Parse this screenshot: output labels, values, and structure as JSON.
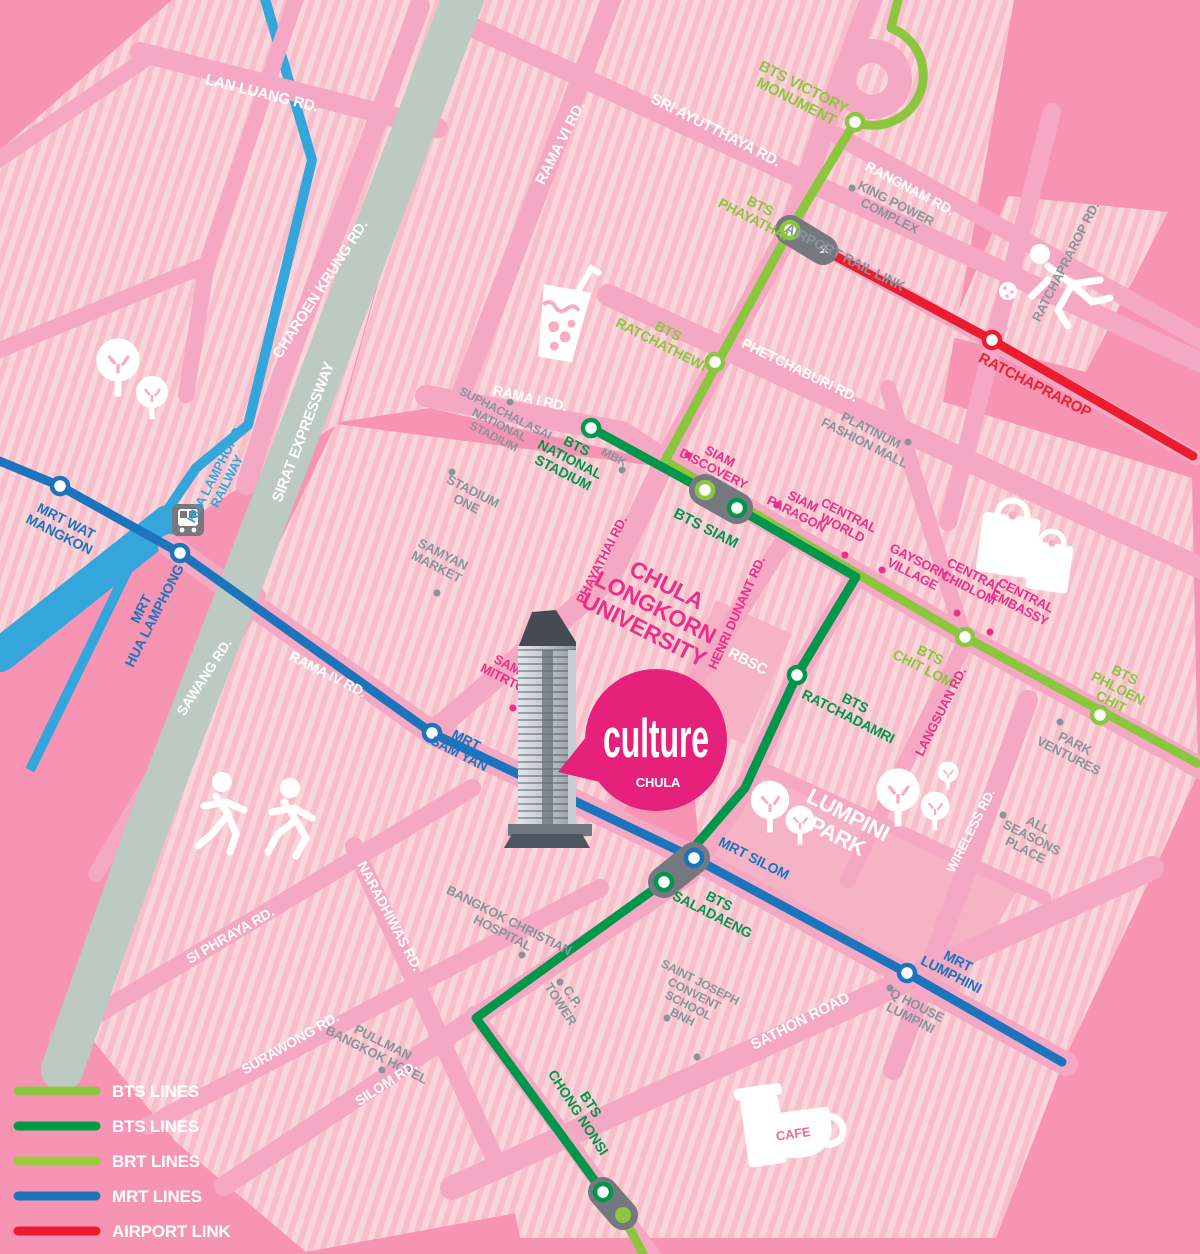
{
  "title": "Culture Chula location map (Bangkok transit map)",
  "palette": {
    "background": "#F794B3",
    "block_base": "#F8BFCB",
    "block_stripe": "#FAD4DB",
    "road": "#F4A8C3",
    "park": "#F7B3C6",
    "expressway": "#BDC9C3",
    "railway_blue": "#35A6DC",
    "bts_light": "#8CC63F",
    "bts_dark": "#00964B",
    "brt": "#9BCB3C",
    "mrt_blue": "#1B74BC",
    "airport_red": "#EB1C2D",
    "gray_text": "#8A939B",
    "pink_text": "#EC2E86",
    "logo_magenta": "#E5217B",
    "capsule_gray": "#75797F"
  },
  "logo": {
    "title": "culture",
    "subtitle": "CHULA"
  },
  "icons": {
    "airplane_glyph": "✈",
    "names": [
      "tree-icon",
      "train-icon",
      "bubble-tea-icon",
      "runner-icon",
      "exercise-icon",
      "shopping-bags-icon",
      "cafe-icon",
      "airplane-icon"
    ]
  },
  "legend": {
    "items": [
      {
        "label": "BTS LINES",
        "color": "#8CC63F"
      },
      {
        "label": "BTS LINES",
        "color": "#009A44"
      },
      {
        "label": "BRT LINES",
        "color": "#9BCB3C"
      },
      {
        "label": "MRT LINES",
        "color": "#1B74BC"
      },
      {
        "label": "AIRPORT LINK",
        "color": "#EB1C2D"
      }
    ]
  },
  "labels": {
    "lan_luang": "LAN LUANG RD.",
    "charoen_krung": "CHAROEN KRUNG RD.",
    "sirat": "SIRAT EXPRESSWAY",
    "rama_vi": "RAMA VI RD.",
    "sri_ayutthaya": "SRI AYUTTHAYA RD.",
    "rangnam": "RANGNAM RD.",
    "king_power": [
      "KING POWER",
      "COMPLEX"
    ],
    "ratchaprarop_rd": "RATCHAPRAROP RD.",
    "victory": [
      "BTS VICTORY",
      "MONUMENT"
    ],
    "phayathai_sta": [
      "BTS",
      "PHAYATHAI"
    ],
    "airport_rail_link": "AIRPORT RAIL LINK",
    "ratchathewi": [
      "BTS",
      "RATCHATHEWI"
    ],
    "phetchaburi": "PHETCHABURI RD.",
    "ratchaprarop_line": "RATCHAPRAROP",
    "platinum": [
      "PLATINUM",
      "FASHION MALL"
    ],
    "rama_i": "RAMA I RD.",
    "suphachalasai": [
      "SUPHACHALASAI",
      "NATIONAL",
      "STADIUM"
    ],
    "national_stadium": [
      "BTS",
      "NATIONAL",
      "STADIUM"
    ],
    "mbk": "MBK",
    "stadium_one": [
      "STADIUM",
      "ONE"
    ],
    "samyan_market": [
      "SAMYAN",
      "MARKET"
    ],
    "siam_discovery": [
      "SIAM",
      "DISCOVERY"
    ],
    "bts_siam": "BTS SIAM",
    "siam_paragon": [
      "SIAM",
      "PARAGON"
    ],
    "central_world": [
      "CENTRAL",
      "WORLD"
    ],
    "gaysorn": [
      "GAYSORN",
      "VILLAGE"
    ],
    "central_chidlom": [
      "CENTRAL",
      "CHIDLOM"
    ],
    "central_embassy": [
      "CENTRAL",
      "EMBASSY"
    ],
    "chit_lom": [
      "BTS",
      "CHIT LOM"
    ],
    "phloen_chit": [
      "BTS",
      "PHLOEN",
      "CHIT"
    ],
    "park_ventures": [
      "PARK",
      "VENTURES"
    ],
    "all_seasons": [
      "ALL",
      "SEASONS",
      "PLACE"
    ],
    "chula_univ": [
      "CHULA",
      "LONGKORN",
      "UNIVERSITY"
    ],
    "henri_dunant": "HENRI DUNANT RD.",
    "rbsc": "RBSC",
    "ratchadamri": [
      "BTS",
      "RATCHADAMRI"
    ],
    "langsuan": "LANGSUAN RD.",
    "wireless": "WIRELESS RD.",
    "phayathai_rd": "PHAYATHAI RD.",
    "samyan_mitrtown": [
      "SAMYAN",
      "MITRTOWN"
    ],
    "mrt_sam_yan": [
      "MRT",
      "SAM YAN"
    ],
    "sawang": "SAWANG RD.",
    "rama_iv": "RAMA IV RD.",
    "mrt_wat_mangkon": [
      "MRT WAT",
      "MANGKON"
    ],
    "mrt_hua_lamphong": [
      "MRT",
      "HUA LAMPHONG"
    ],
    "hua_lamphong_railway": [
      "HUA LAMPHONG",
      "RAILWAY"
    ],
    "lumpini": [
      "LUMPINI",
      "PARK"
    ],
    "mrt_silom": "MRT SILOM",
    "saladaeng": [
      "BTS",
      "SALADAENG"
    ],
    "mrt_lumphini": [
      "MRT",
      "LUMPHINI"
    ],
    "q_house": [
      "Q HOUSE",
      "LUMPINI"
    ],
    "saint_joseph": [
      "SAINT JOSEPH",
      "CONVENT",
      "SCHOOL",
      "BNH"
    ],
    "sathon": "SATHON ROAD",
    "bkk_christian": [
      "BANGKOK CHRISTIAN",
      "HOSPITAL"
    ],
    "cp_tower": [
      "C.P.",
      "TOWER"
    ],
    "pullman": [
      "PULLMAN",
      "BANGKOK HOTEL"
    ],
    "naradhiwas": "NARADHIWAS RD.",
    "surawong": "SURAWONG RD.",
    "silom_rd": "SILOM RD.",
    "si_phraya": "SI PHRAYA RD.",
    "chong_nonsi": [
      "BTS",
      "CHONG NONSI"
    ],
    "cafe": "CAFE"
  }
}
